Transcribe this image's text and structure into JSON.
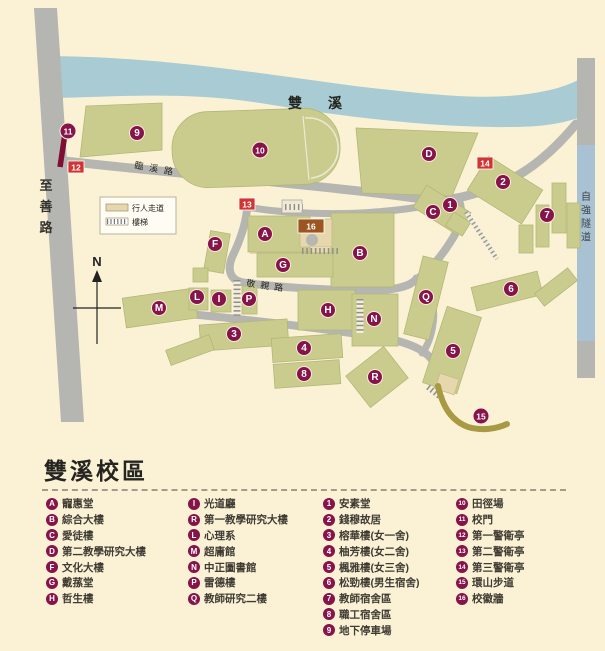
{
  "colors": {
    "bg": "#fbf2d6",
    "river": "#a9ccd4",
    "road": "#b5b5b2",
    "building": "#c9cc8d",
    "building_edge": "#b4b778",
    "tan": "#e6d7ac",
    "marker": "#86134a",
    "marker_red": "#d23333",
    "marker_brown": "#9c5420",
    "gate": "#7d0f35",
    "trail": "#a79a43",
    "tunnel_blue": "#a9c2d3",
    "text_dark": "#25241f"
  },
  "map": {
    "labels": {
      "river": "雙溪",
      "left_road": "至善路",
      "tunnel": "自強隧道",
      "road_linxi": "臨溪路",
      "road_jingqin": "敬親路",
      "compass": "N"
    },
    "key": {
      "walkway": "行人走道",
      "stairs": "樓梯"
    },
    "markers": [
      {
        "label": "A",
        "x": 265,
        "y": 234,
        "shape": "circle"
      },
      {
        "label": "B",
        "x": 360,
        "y": 253,
        "shape": "circle"
      },
      {
        "label": "C",
        "x": 433,
        "y": 212,
        "shape": "circle"
      },
      {
        "label": "D",
        "x": 429,
        "y": 154,
        "shape": "circle"
      },
      {
        "label": "F",
        "x": 215,
        "y": 244,
        "shape": "circle"
      },
      {
        "label": "G",
        "x": 283,
        "y": 265,
        "shape": "circle"
      },
      {
        "label": "H",
        "x": 328,
        "y": 310,
        "shape": "circle"
      },
      {
        "label": "I",
        "x": 219,
        "y": 299,
        "shape": "circle"
      },
      {
        "label": "L",
        "x": 197,
        "y": 297,
        "shape": "circle"
      },
      {
        "label": "M",
        "x": 159,
        "y": 308,
        "shape": "circle"
      },
      {
        "label": "N",
        "x": 374,
        "y": 319,
        "shape": "circle"
      },
      {
        "label": "P",
        "x": 249,
        "y": 299,
        "shape": "circle"
      },
      {
        "label": "Q",
        "x": 426,
        "y": 297,
        "shape": "circle"
      },
      {
        "label": "R",
        "x": 375,
        "y": 377,
        "shape": "circle"
      },
      {
        "label": "1",
        "x": 450,
        "y": 205,
        "shape": "circle"
      },
      {
        "label": "2",
        "x": 503,
        "y": 182,
        "shape": "circle"
      },
      {
        "label": "3",
        "x": 234,
        "y": 334,
        "shape": "circle"
      },
      {
        "label": "4",
        "x": 304,
        "y": 348,
        "shape": "circle"
      },
      {
        "label": "5",
        "x": 453,
        "y": 351,
        "shape": "circle"
      },
      {
        "label": "6",
        "x": 511,
        "y": 289,
        "shape": "circle"
      },
      {
        "label": "7",
        "x": 547,
        "y": 215,
        "shape": "circle"
      },
      {
        "label": "8",
        "x": 304,
        "y": 374,
        "shape": "circle"
      },
      {
        "label": "9",
        "x": 137,
        "y": 133,
        "shape": "circle"
      },
      {
        "label": "10",
        "x": 260,
        "y": 150,
        "shape": "circle"
      },
      {
        "label": "11",
        "x": 68,
        "y": 131,
        "shape": "circle"
      },
      {
        "label": "15",
        "x": 481,
        "y": 416,
        "shape": "circle"
      },
      {
        "label": "12",
        "x": 76,
        "y": 167,
        "shape": "square"
      },
      {
        "label": "13",
        "x": 247,
        "y": 204,
        "shape": "square"
      },
      {
        "label": "14",
        "x": 485,
        "y": 163,
        "shape": "square"
      },
      {
        "label": "16",
        "x": 311,
        "y": 226,
        "shape": "square-brown"
      }
    ]
  },
  "legend": {
    "title": "雙溪校區",
    "columns": [
      {
        "items": [
          {
            "key": "A",
            "name": "寵惠堂"
          },
          {
            "key": "B",
            "name": "綜合大樓"
          },
          {
            "key": "C",
            "name": "愛徒樓"
          },
          {
            "key": "D",
            "name": "第二教學研究大樓"
          },
          {
            "key": "F",
            "name": "文化大樓"
          },
          {
            "key": "G",
            "name": "戴蓀堂"
          },
          {
            "key": "H",
            "name": "哲生樓"
          }
        ]
      },
      {
        "items": [
          {
            "key": "I",
            "name": "光道廳"
          },
          {
            "key": "R",
            "name": "第一教學研究大樓"
          },
          {
            "key": "L",
            "name": "心理系"
          },
          {
            "key": "M",
            "name": "超庸館"
          },
          {
            "key": "N",
            "name": "中正圖書館"
          },
          {
            "key": "P",
            "name": "雷德樓"
          },
          {
            "key": "Q",
            "name": "教師研究二樓"
          }
        ]
      },
      {
        "items": [
          {
            "key": "1",
            "name": "安素堂"
          },
          {
            "key": "2",
            "name": "錢穆故居"
          },
          {
            "key": "3",
            "name": "榕華樓(女一舍)"
          },
          {
            "key": "4",
            "name": "柚芳樓(女二舍)"
          },
          {
            "key": "5",
            "name": "楓雅樓(女三舍)"
          },
          {
            "key": "6",
            "name": "松勁樓(男生宿舍)"
          },
          {
            "key": "7",
            "name": "教師宿舍區"
          },
          {
            "key": "8",
            "name": "職工宿舍區"
          },
          {
            "key": "9",
            "name": "地下停車場"
          }
        ]
      },
      {
        "items": [
          {
            "key": "10",
            "name": "田徑場"
          },
          {
            "key": "11",
            "name": "校門"
          },
          {
            "key": "12",
            "name": "第一警衛亭"
          },
          {
            "key": "13",
            "name": "第二警衛亭"
          },
          {
            "key": "14",
            "name": "第三警衛亭"
          },
          {
            "key": "15",
            "name": "環山步道"
          },
          {
            "key": "16",
            "name": "校徽牆"
          }
        ]
      }
    ]
  }
}
